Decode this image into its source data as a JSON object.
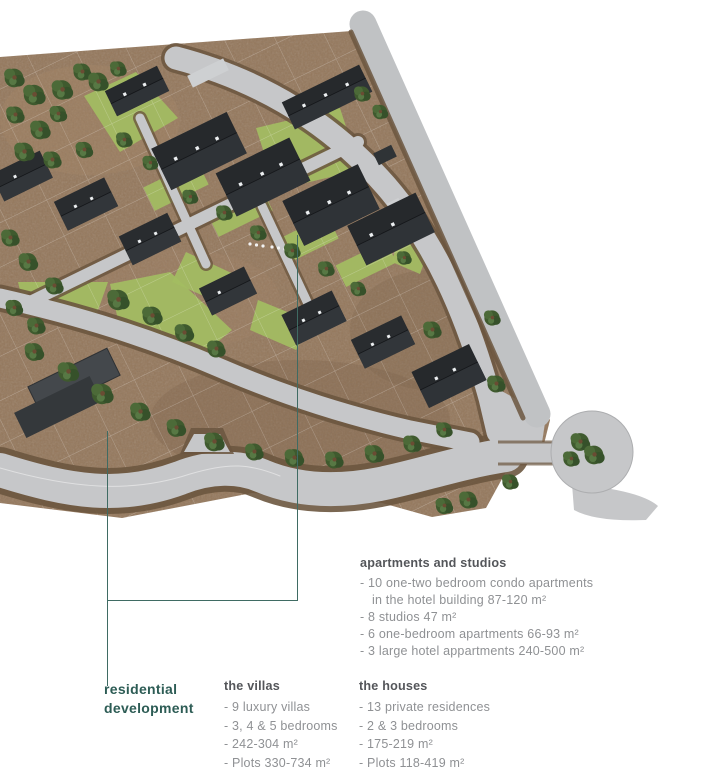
{
  "map_label": {
    "line1": "residential",
    "line2": "development"
  },
  "sections": {
    "apartments": {
      "heading": "apartments and studios",
      "items": [
        "- 10 one-two bedroom condo apartments",
        "in the hotel building 87-120 m²",
        "- 8 studios 47 m²",
        "- 6 one-bedroom apartments 66-93 m²",
        "- 3 large hotel appartments 240-500 m²"
      ]
    },
    "villas": {
      "heading": "the villas",
      "items": [
        "- 9 luxury villas",
        "- 3, 4 & 5 bedrooms",
        "- 242-304 m²",
        "- Plots 330-734 m²"
      ]
    },
    "houses": {
      "heading": "the houses",
      "items": [
        "- 13 private residences",
        "- 2 & 3 bedrooms",
        "- 175-219 m²",
        "- Plots 118-419 m²"
      ]
    }
  },
  "colors": {
    "accent": "#2d5c55",
    "leader_line": "#3f6b63",
    "heading_text": "#54565a",
    "body_text": "#8f9194",
    "terrain_brown": "#94775b",
    "road_gray": "#c6c7c9",
    "curb_brown": "#6b563f",
    "lawn_green": "#a3bd62",
    "tree_green": "#3f5a2e",
    "roof_dark": "#26292c",
    "background": "#ffffff"
  }
}
